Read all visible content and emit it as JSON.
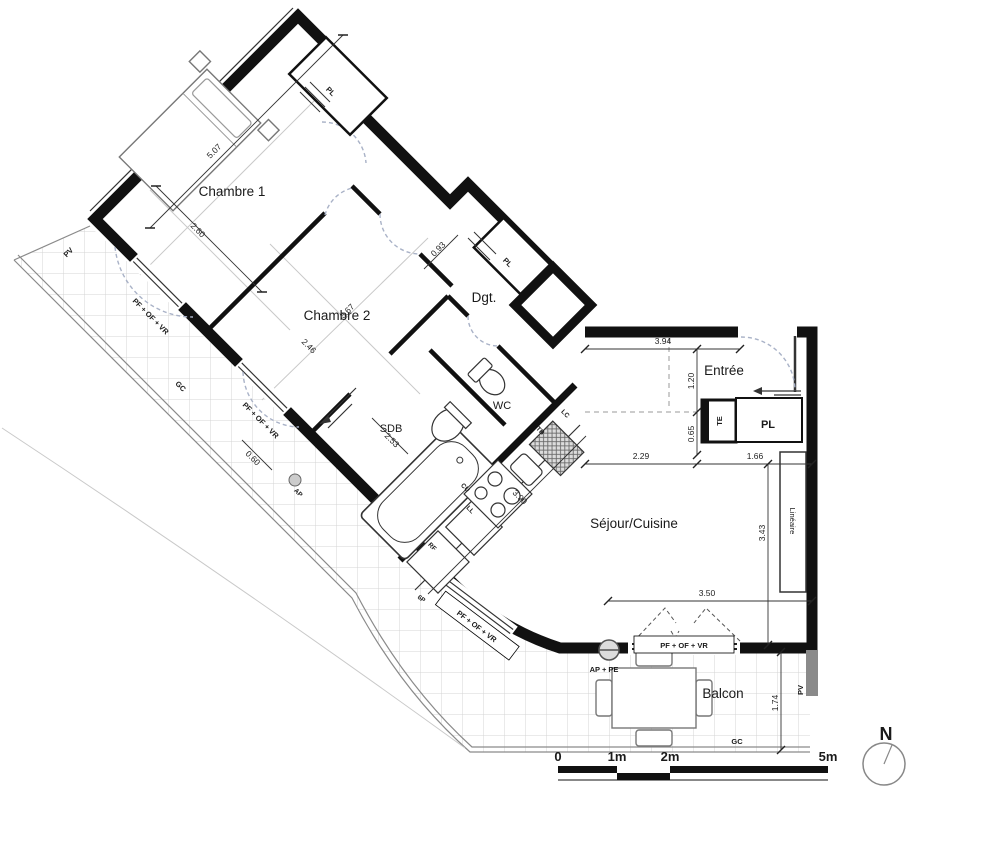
{
  "colors": {
    "wall": "#111111",
    "swing_dash": "#a9b2c7",
    "tile_line": "#d4d4d4",
    "accent": "#000000"
  },
  "rooms": {
    "chambre1": "Chambre 1",
    "chambre2": "Chambre 2",
    "degagement": "Dgt.",
    "sdb": "SDB",
    "wc": "WC",
    "entree": "Entrée",
    "sejour": "Séjour/Cuisine",
    "balcon": "Balcon"
  },
  "closets": {
    "pl": "PL",
    "te": "TE",
    "lineaire": "Linéaire"
  },
  "appliances": {
    "rf": "RF",
    "ll": "LL",
    "cu": "CU",
    "tb": "TB",
    "lc": "LC"
  },
  "openings": {
    "window_label": "PF + OF + VR",
    "door_label": "6P"
  },
  "site": {
    "pv": "PV",
    "gc": "GC",
    "ap": "AP",
    "ap_pe": "AP + PE"
  },
  "dimensions": {
    "d507": "5.07",
    "d260": "2.60",
    "d246": "2.46",
    "d367": "3.67",
    "d093": "0.93",
    "d394": "3.94",
    "d120": "1.20",
    "d065": "0.65",
    "d229": "2.29",
    "d166": "1.66",
    "d343": "3.43",
    "d350": "3.50",
    "d174": "1.74",
    "d060": "0.60",
    "d253": "2.53",
    "d390": "3.90"
  },
  "scale_bar": {
    "t0": "0",
    "t1": "1m",
    "t2": "2m",
    "t5": "5m"
  },
  "north": {
    "label": "N"
  }
}
